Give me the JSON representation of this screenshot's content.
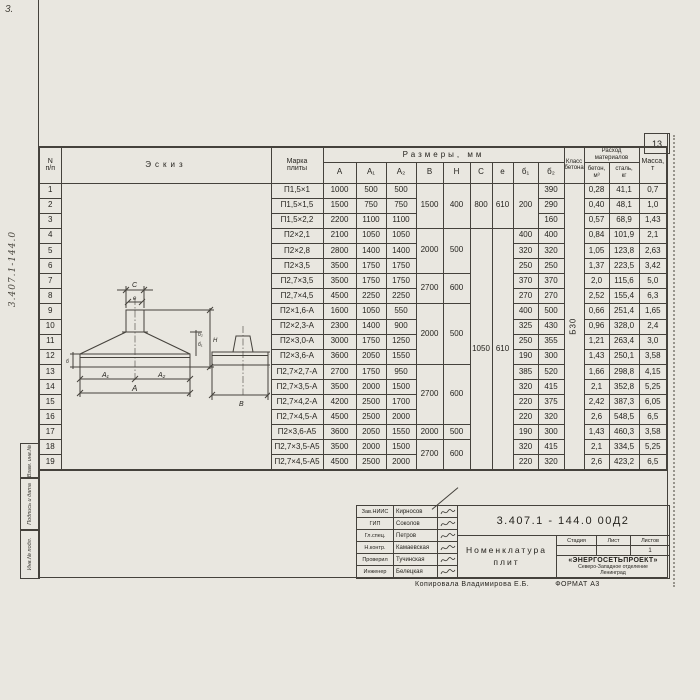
{
  "page": {
    "number": "13",
    "corner_note": "3.",
    "margin_note": "3.407.1-144.0"
  },
  "side_stamps": {
    "s1": "Взам. инв.№",
    "s2": "Подпись и дата",
    "s3": "Инв.№ подл."
  },
  "table": {
    "headers": {
      "num_line1": "N",
      "num_line2": "п/п",
      "sketch": "Эскиз",
      "mark_line1": "Марка",
      "mark_line2": "плиты",
      "dims": "Размеры, мм",
      "col_A": "A",
      "col_A1": "A₁",
      "col_A2": "A₂",
      "col_B": "B",
      "col_H": "H",
      "col_C": "C",
      "col_e": "e",
      "col_d1": "б₁",
      "col_d2": "б₂",
      "class_line1": "Класс",
      "class_line2": "бетона",
      "cons_line1": "Расход",
      "cons_line2": "материалов",
      "concrete_line1": "бетон,",
      "concrete_line2": "м³",
      "steel_line1": "сталь,",
      "steel_line2": "кг",
      "mass_line1": "Масса,",
      "mass_line2": "т"
    },
    "merges": {
      "concrete_class": "Б30",
      "b_h_groups": [
        {
          "start": 1,
          "span": 3,
          "B": "1500",
          "H": "400"
        },
        {
          "start": 4,
          "span": 3,
          "B": "2000",
          "H": "500"
        },
        {
          "start": 7,
          "span": 2,
          "B": "2700",
          "H": "600"
        },
        {
          "start": 9,
          "span": 4,
          "B": "2000",
          "H": "500"
        },
        {
          "start": 13,
          "span": 4,
          "B": "2700",
          "H": "600"
        },
        {
          "start": 17,
          "span": 1,
          "B": "2000",
          "H": "500"
        },
        {
          "start": 18,
          "span": 2,
          "B": "2700",
          "H": "600"
        }
      ],
      "c_e_groups": [
        {
          "start": 1,
          "span": 3,
          "C": "800",
          "e": "610"
        },
        {
          "start": 4,
          "span": 16,
          "C": "1050",
          "e": "610"
        }
      ],
      "b1_groups": [
        {
          "start": 1,
          "span": 3,
          "value": "200"
        }
      ]
    },
    "rows": [
      {
        "n": "1",
        "mark": "П1,5×1",
        "A": "1000",
        "A1": "500",
        "A2": "500",
        "b1": "",
        "b2": "390",
        "concrete": "0,28",
        "steel": "41,1",
        "mass": "0,7"
      },
      {
        "n": "2",
        "mark": "П1,5×1,5",
        "A": "1500",
        "A1": "750",
        "A2": "750",
        "b1": "",
        "b2": "290",
        "concrete": "0,40",
        "steel": "48,1",
        "mass": "1,0"
      },
      {
        "n": "3",
        "mark": "П1,5×2,2",
        "A": "2200",
        "A1": "1100",
        "A2": "1100",
        "b1": "",
        "b2": "160",
        "concrete": "0,57",
        "steel": "68,9",
        "mass": "1,43"
      },
      {
        "n": "4",
        "mark": "П2×2,1",
        "A": "2100",
        "A1": "1050",
        "A2": "1050",
        "b1": "400",
        "b2": "400",
        "concrete": "0,84",
        "steel": "101,9",
        "mass": "2,1"
      },
      {
        "n": "5",
        "mark": "П2×2,8",
        "A": "2800",
        "A1": "1400",
        "A2": "1400",
        "b1": "320",
        "b2": "320",
        "concrete": "1,05",
        "steel": "123,8",
        "mass": "2,63"
      },
      {
        "n": "6",
        "mark": "П2×3,5",
        "A": "3500",
        "A1": "1750",
        "A2": "1750",
        "b1": "250",
        "b2": "250",
        "concrete": "1,37",
        "steel": "223,5",
        "mass": "3,42"
      },
      {
        "n": "7",
        "mark": "П2,7×3,5",
        "A": "3500",
        "A1": "1750",
        "A2": "1750",
        "b1": "370",
        "b2": "370",
        "concrete": "2,0",
        "steel": "115,6",
        "mass": "5,0"
      },
      {
        "n": "8",
        "mark": "П2,7×4,5",
        "A": "4500",
        "A1": "2250",
        "A2": "2250",
        "b1": "270",
        "b2": "270",
        "concrete": "2,52",
        "steel": "155,4",
        "mass": "6,3"
      },
      {
        "n": "9",
        "mark": "П2×1,6-А",
        "A": "1600",
        "A1": "1050",
        "A2": "550",
        "b1": "400",
        "b2": "500",
        "concrete": "0,66",
        "steel": "251,4",
        "mass": "1,65"
      },
      {
        "n": "10",
        "mark": "П2×2,3-А",
        "A": "2300",
        "A1": "1400",
        "A2": "900",
        "b1": "325",
        "b2": "430",
        "concrete": "0,96",
        "steel": "328,0",
        "mass": "2,4"
      },
      {
        "n": "11",
        "mark": "П2×3,0-А",
        "A": "3000",
        "A1": "1750",
        "A2": "1250",
        "b1": "250",
        "b2": "355",
        "concrete": "1,21",
        "steel": "263,4",
        "mass": "3,0"
      },
      {
        "n": "12",
        "mark": "П2×3,6-А",
        "A": "3600",
        "A1": "2050",
        "A2": "1550",
        "b1": "190",
        "b2": "300",
        "concrete": "1,43",
        "steel": "250,1",
        "mass": "3,58"
      },
      {
        "n": "13",
        "mark": "П2,7×2,7-А",
        "A": "2700",
        "A1": "1750",
        "A2": "950",
        "b1": "385",
        "b2": "520",
        "concrete": "1,66",
        "steel": "298,8",
        "mass": "4,15"
      },
      {
        "n": "14",
        "mark": "П2,7×3,5-А",
        "A": "3500",
        "A1": "2000",
        "A2": "1500",
        "b1": "320",
        "b2": "415",
        "concrete": "2,1",
        "steel": "352,8",
        "mass": "5,25"
      },
      {
        "n": "15",
        "mark": "П2,7×4,2-А",
        "A": "4200",
        "A1": "2500",
        "A2": "1700",
        "b1": "220",
        "b2": "375",
        "concrete": "2,42",
        "steel": "387,3",
        "mass": "6,05"
      },
      {
        "n": "16",
        "mark": "П2,7×4,5-А",
        "A": "4500",
        "A1": "2500",
        "A2": "2000",
        "b1": "220",
        "b2": "320",
        "concrete": "2,6",
        "steel": "548,5",
        "mass": "6,5"
      },
      {
        "n": "17",
        "mark": "П2×3,6-А5",
        "A": "3600",
        "A1": "2050",
        "A2": "1550",
        "b1": "190",
        "b2": "300",
        "concrete": "1,43",
        "steel": "460,3",
        "mass": "3,58"
      },
      {
        "n": "18",
        "mark": "П2,7×3,5-А5",
        "A": "3500",
        "A1": "2000",
        "A2": "1500",
        "b1": "320",
        "b2": "415",
        "concrete": "2,1",
        "steel": "334,5",
        "mass": "5,25"
      },
      {
        "n": "19",
        "mark": "П2,7×4,5-А5",
        "A": "4500",
        "A1": "2500",
        "A2": "2000",
        "b1": "220",
        "b2": "320",
        "concrete": "2,6",
        "steel": "423,2",
        "mass": "6,5"
      }
    ]
  },
  "sketch_labels": {
    "c": "C",
    "e": "e",
    "a1": "A₁",
    "a2": "A₂",
    "a": "A",
    "b": "B",
    "h": "H",
    "d1": "б₁",
    "d2": "б₂",
    "d0": "б",
    "t100": "100"
  },
  "titleblock": {
    "doc_number": "3.407.1 - 144.0  00Д2",
    "title_line1": "Номенклатура",
    "title_line2": "плит",
    "stage_label": "Стадия",
    "sheet_label": "Лист",
    "sheets_label": "Листов",
    "stage_value": "",
    "sheet_value": "",
    "sheets_value": "1",
    "org_line1": "«ЭНЕРГОСЕТЬПРОЕКТ»",
    "org_line2": "Северо-Западное отделение",
    "org_line3": "Ленинград",
    "people": [
      {
        "role": "Зав.НИИС",
        "name": "Кирносов"
      },
      {
        "role": "ГИП",
        "name": "Соколов"
      },
      {
        "role": "Гл.спец.",
        "name": "Петров"
      },
      {
        "role": "Н.контр.",
        "name": "Камаевская"
      },
      {
        "role": "Проверил",
        "name": "Тучинская"
      },
      {
        "role": "Инженер",
        "name": "Белецкая"
      }
    ]
  },
  "footer": {
    "copy_line": "Копировала  Владимирова Е.Б.",
    "format_label": "ФОРМАТ А3"
  }
}
